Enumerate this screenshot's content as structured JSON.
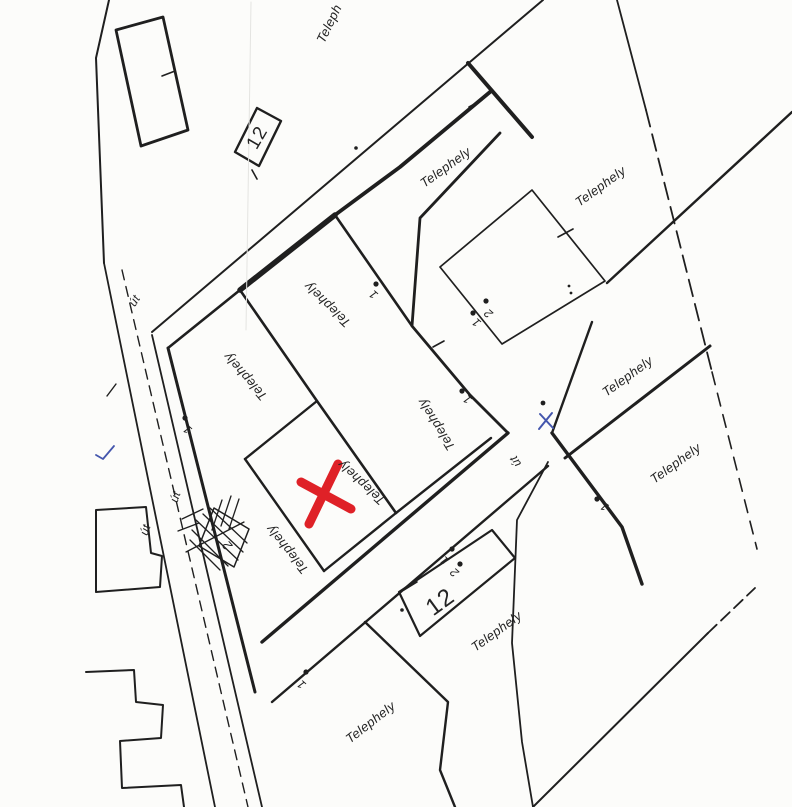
{
  "map": {
    "background": "#fcfcfa",
    "ink": "#1f1f1f",
    "red_accent": "#df2127",
    "blue_accent": "#4456ad",
    "plot_labels": [
      {
        "text": "Teleph",
        "x": 330,
        "y": 24,
        "rot": -64,
        "size": 13,
        "cls": "lbl",
        "n": "plot-label-top-clipped"
      },
      {
        "text": "Telephely",
        "x": 446,
        "y": 168,
        "rot": -36,
        "size": 13,
        "cls": "lbl",
        "n": "plot-label"
      },
      {
        "text": "Telephely",
        "x": 601,
        "y": 187,
        "rot": -36,
        "size": 13,
        "cls": "lbl",
        "n": "plot-label"
      },
      {
        "text": "Telephely",
        "x": 628,
        "y": 377,
        "rot": -36,
        "size": 13,
        "cls": "lbl",
        "n": "plot-label"
      },
      {
        "text": "Telephely",
        "x": 676,
        "y": 464,
        "rot": -36,
        "size": 13,
        "cls": "lbl",
        "n": "plot-label"
      },
      {
        "text": "Telephely",
        "x": 497,
        "y": 632,
        "rot": -36,
        "size": 13,
        "cls": "lbl",
        "n": "plot-label"
      },
      {
        "text": "Telephely",
        "x": 371,
        "y": 723,
        "rot": -38,
        "size": 13,
        "cls": "lbl",
        "n": "plot-label"
      },
      {
        "text": "Telephely",
        "x": 328,
        "y": 304,
        "rot": 224,
        "size": 13,
        "cls": "lbl",
        "n": "plot-label-upside-down"
      },
      {
        "text": "Telephely",
        "x": 246,
        "y": 376,
        "rot": 229,
        "size": 13,
        "cls": "lbl",
        "n": "plot-label-upside-down"
      },
      {
        "text": "Telephely",
        "x": 437,
        "y": 424,
        "rot": 238,
        "size": 13,
        "cls": "lbl",
        "n": "plot-label-upside-down"
      },
      {
        "text": "Telephely",
        "x": 362,
        "y": 482,
        "rot": 223,
        "size": 13,
        "cls": "lbl",
        "n": "plot-label-marked-plot"
      },
      {
        "text": "Telephely",
        "x": 288,
        "y": 549,
        "rot": 231,
        "size": 13,
        "cls": "lbl",
        "n": "plot-label-upside-down"
      }
    ],
    "road_labels": [
      {
        "text": "út",
        "x": 135,
        "y": 301,
        "rot": -58,
        "size": 12,
        "cls": "lbl",
        "n": "road-label"
      },
      {
        "text": "út",
        "x": 176,
        "y": 497,
        "rot": -71,
        "size": 12,
        "cls": "lbl",
        "n": "road-label"
      },
      {
        "text": "út",
        "x": 146,
        "y": 530,
        "rot": -71,
        "size": 12,
        "cls": "lbl",
        "n": "road-label"
      },
      {
        "text": "út",
        "x": 516,
        "y": 461,
        "rot": 238,
        "size": 12,
        "cls": "lbl",
        "n": "road-label"
      }
    ],
    "parcel_numbers": [
      {
        "text": "12",
        "x": 258,
        "y": 138,
        "rot": -60,
        "size": 19,
        "cls": "big",
        "n": "parcel-number-12"
      },
      {
        "text": "12",
        "x": 441,
        "y": 603,
        "rot": -36,
        "size": 24,
        "cls": "big",
        "n": "parcel-number-12"
      }
    ],
    "point_numbers": [
      {
        "text": "1",
        "x": 188,
        "y": 429,
        "rot": 222,
        "size": 12,
        "cls": "num",
        "n": "point-number"
      },
      {
        "text": "1",
        "x": 374,
        "y": 294,
        "rot": 222,
        "size": 12,
        "cls": "num",
        "n": "point-number"
      },
      {
        "text": "1",
        "x": 468,
        "y": 399,
        "rot": 222,
        "size": 12,
        "cls": "num",
        "n": "point-number"
      },
      {
        "text": "1",
        "x": 477,
        "y": 322,
        "rot": 222,
        "size": 12,
        "cls": "num",
        "n": "point-number"
      },
      {
        "text": "1",
        "x": 445,
        "y": 560,
        "rot": 222,
        "size": 12,
        "cls": "num",
        "n": "point-number"
      },
      {
        "text": "1",
        "x": 302,
        "y": 684,
        "rot": 222,
        "size": 12,
        "cls": "num",
        "n": "point-number"
      },
      {
        "text": "1",
        "x": 605,
        "y": 506,
        "rot": 215,
        "size": 12,
        "cls": "num",
        "n": "point-number"
      },
      {
        "text": "2",
        "x": 489,
        "y": 313,
        "rot": 222,
        "size": 12,
        "cls": "num",
        "n": "point-number"
      },
      {
        "text": "2",
        "x": 455,
        "y": 572,
        "rot": 222,
        "size": 12,
        "cls": "num",
        "n": "point-number"
      },
      {
        "text": "2",
        "x": 228,
        "y": 545,
        "rot": 228,
        "size": 13,
        "cls": "num",
        "n": "point-number"
      }
    ],
    "lines": [
      {
        "d": "M 109 0 L 96 58 L 104 263",
        "w": 2,
        "n": "west-boundary-line"
      },
      {
        "d": "M 116 30 L 163 17 L 188 130 L 141 146 Z",
        "w": 2.8,
        "n": "building-outline"
      },
      {
        "d": "M 162 76 l 13 -5",
        "w": 1.6,
        "n": "survey-tick"
      },
      {
        "d": "M 235 152 L 257 108 L 281 121 L 259 166 Z",
        "w": 2.4,
        "n": "building-12-outline"
      },
      {
        "d": "M 252 170 l 5 9",
        "w": 1.6,
        "n": "survey-tick"
      },
      {
        "d": "M 543 0 L 152 332",
        "w": 2,
        "n": "street-nw-edge"
      },
      {
        "d": "M 490 92 L 400 167 L 335 215",
        "w": 3.8,
        "n": "street-se-edge-thick"
      },
      {
        "d": "M 335 215 L 240 290",
        "w": 5.5,
        "n": "plot-edge-extra-thick"
      },
      {
        "d": "M 240 290 L 168 348",
        "w": 2.6,
        "n": "plot-edge"
      },
      {
        "d": "M 500 133 L 420 218 L 412 326 L 470 395 L 508 433",
        "w": 2.8,
        "n": "central-road-west-edge"
      },
      {
        "d": "M 335 215 L 412 326",
        "w": 2.6,
        "n": "plot-edge"
      },
      {
        "d": "M 468 63 L 532 137",
        "w": 4,
        "n": "central-road-east-edge-thick"
      },
      {
        "d": "M 469 107 l 13 -7",
        "w": 1.6,
        "n": "survey-tick"
      },
      {
        "d": "M 240 290 L 317 401 L 396 513",
        "w": 2.6,
        "n": "plot-divider"
      },
      {
        "d": "M 317 401 L 245 459",
        "w": 2.4,
        "n": "plot-divider"
      },
      {
        "d": "M 245 459 L 324 571",
        "w": 2.4,
        "n": "plot-divider"
      },
      {
        "d": "M 396 513 L 324 571",
        "w": 2.4,
        "n": "plot-divider"
      },
      {
        "d": "M 396 513 L 491 438",
        "w": 2.4,
        "n": "plot-divider"
      },
      {
        "d": "M 433 347 l 11 -6",
        "w": 1.6,
        "n": "survey-tick"
      },
      {
        "d": "M 104 263 L 215 807",
        "w": 1.8,
        "n": "left-road-west-edge"
      },
      {
        "d": "M 122 270 L 248 807",
        "w": 1.4,
        "dash": "10 7",
        "n": "left-road-centerline"
      },
      {
        "d": "M 152 335 L 262 807",
        "w": 1.8,
        "n": "left-road-east-edge"
      },
      {
        "d": "M 168 348 L 255 692",
        "w": 3,
        "n": "block-west-edge"
      },
      {
        "d": "M 107 396 L 116 384",
        "w": 1.4,
        "n": "stray-mark"
      },
      {
        "d": "M 262 642 L 508 433",
        "w": 3.4,
        "n": "cross-road-nw-edge"
      },
      {
        "d": "M 272 702 L 548 466",
        "w": 2.4,
        "n": "cross-road-se-edge"
      },
      {
        "d": "M 548 462 L 517 520 L 512 643 L 522 742 L 533 807",
        "w": 1.8,
        "n": "south-road-west-edge"
      },
      {
        "d": "M 552 433 L 622 527 L 642 584",
        "w": 3.4,
        "n": "south-road-east-edge"
      },
      {
        "d": "M 592 322 L 552 433",
        "w": 2.4,
        "n": "right-block-west-edge"
      },
      {
        "d": "M 532 190 L 605 281 L 502 344 L 440 267 Z",
        "w": 1.7,
        "n": "building-outline"
      },
      {
        "d": "M 558 237 l 15 -8",
        "w": 1.6,
        "n": "survey-tick"
      },
      {
        "d": "M 607 283 L 792 112",
        "w": 2.4,
        "n": "plot-divider"
      },
      {
        "d": "M 565 458 L 710 346",
        "w": 3,
        "n": "plot-divider"
      },
      {
        "d": "M 617 0 L 646 110",
        "w": 1.8,
        "n": "east-boundary"
      },
      {
        "d": "M 646 110 L 712 372",
        "w": 1.8,
        "dash": "17 8",
        "n": "east-boundary-dashed"
      },
      {
        "d": "M 712 372 L 757 549",
        "w": 1.6,
        "dash": "13 9",
        "n": "east-boundary-dashed"
      },
      {
        "d": "M 533 807 L 708 633",
        "w": 2,
        "n": "southeast-boundary"
      },
      {
        "d": "M 708 633 L 755 588",
        "w": 1.8,
        "dash": "12 6",
        "n": "southeast-boundary-dashed"
      },
      {
        "d": "M 365 622 L 448 702 L 440 770 L 455 807",
        "w": 2.4,
        "n": "plot-divider"
      },
      {
        "d": "M 399 592 L 492 530 L 515 558 L 420 636 Z",
        "w": 2.2,
        "n": "building-12-outline"
      },
      {
        "d": "M 404 590 l 13 -8",
        "w": 1.6,
        "n": "survey-tick"
      },
      {
        "d": "M 96 592 L 96 510 L 146 507 L 151 553 L 162 556 L 160 587 Z",
        "w": 2,
        "n": "stepped-parcel-outline"
      },
      {
        "d": "M 86 672 L 134 670 L 136 702 L 163 705 L 161 738 L 120 741 L 122 788 L 181 785 L 184 807",
        "w": 2,
        "n": "stepped-parcel-outline"
      },
      {
        "d": "M 214 508 L 249 529 L 234 567 L 199 546 Z",
        "w": 1.5,
        "n": "hatched-structure-outline"
      },
      {
        "d": "M 196 520 L 238 560 M 203 514 L 243 552 M 210 508 L 247 543 M 192 530 L 228 566 M 190 540 L 220 570 M 222 500 L 212 530 M 231 496 L 221 526 M 239 499 L 229 529 M 182 519 L 203 509 M 178 531 L 199 523 M 186 552 L 244 522",
        "w": 1.3,
        "n": "hatch-strokes"
      },
      {
        "d": "M 251 2 L 246 330",
        "w": 1,
        "c": "#e4e4e1",
        "n": "scan-fold-line"
      },
      {
        "d": "M 338 464 L 309 524 M 301 482 L 351 509",
        "w": 9,
        "c": "#df2127",
        "n": "red-x-marker"
      },
      {
        "d": "M 540 414 L 553 428 M 552 413 L 539 429",
        "w": 2,
        "c": "#4456ad",
        "n": "blue-pen-mark"
      },
      {
        "d": "M 96 455 L 103 459 L 114 446",
        "w": 1.8,
        "c": "#4456ad",
        "n": "blue-check-mark"
      }
    ],
    "dots": [
      {
        "x": 185,
        "y": 418,
        "r": 2.6
      },
      {
        "x": 376,
        "y": 284,
        "r": 2.6
      },
      {
        "x": 462,
        "y": 391,
        "r": 2.6
      },
      {
        "x": 473,
        "y": 313,
        "r": 2.6
      },
      {
        "x": 486,
        "y": 301,
        "r": 2.6
      },
      {
        "x": 452,
        "y": 549,
        "r": 2.6
      },
      {
        "x": 460,
        "y": 564,
        "r": 2.6
      },
      {
        "x": 306,
        "y": 672,
        "r": 2.6
      },
      {
        "x": 597,
        "y": 499,
        "r": 2.6
      },
      {
        "x": 543,
        "y": 403,
        "r": 2.4
      },
      {
        "x": 402,
        "y": 610,
        "r": 1.8
      },
      {
        "x": 569,
        "y": 286,
        "r": 1.4
      },
      {
        "x": 571,
        "y": 293,
        "r": 1.4
      },
      {
        "x": 356,
        "y": 148,
        "r": 1.8
      }
    ]
  }
}
